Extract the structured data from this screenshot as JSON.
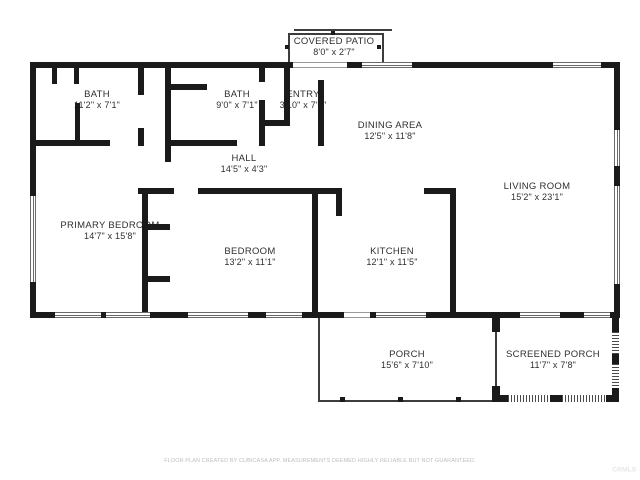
{
  "colors": {
    "wall": "#1a1a1a",
    "thin": "#3d3d3d",
    "text": "#2f2f2f",
    "footer": "#bdbdbd",
    "watermark": "#e6e6e6"
  },
  "rooms": [
    {
      "id": "covered-patio",
      "name": "COVERED PATIO",
      "dims": "8'0\" x 2'7\""
    },
    {
      "id": "bath-1",
      "name": "BATH",
      "dims": "11'2\" x 7'1\""
    },
    {
      "id": "bath-2",
      "name": "BATH",
      "dims": "9'0\" x 7'1\""
    },
    {
      "id": "entry",
      "name": "ENTRY",
      "dims": "3'10\" x 7'1\""
    },
    {
      "id": "dining-area",
      "name": "DINING AREA",
      "dims": "12'5\" x 11'8\""
    },
    {
      "id": "hall",
      "name": "HALL",
      "dims": "14'5\" x 4'3\""
    },
    {
      "id": "living-room",
      "name": "LIVING ROOM",
      "dims": "15'2\" x 23'1\""
    },
    {
      "id": "primary-bedroom",
      "name": "PRIMARY BEDROOM",
      "dims": "14'7\" x 15'8\""
    },
    {
      "id": "bedroom",
      "name": "BEDROOM",
      "dims": "13'2\" x 11'1\""
    },
    {
      "id": "kitchen",
      "name": "KITCHEN",
      "dims": "12'1\" x 11'5\""
    },
    {
      "id": "porch",
      "name": "PORCH",
      "dims": "15'6\" x 7'10\""
    },
    {
      "id": "screened-porch",
      "name": "SCREENED PORCH",
      "dims": "11'7\" x 7'8\""
    }
  ],
  "footer_text": "FLOOR PLAN CREATED BY CUBICASA APP. MEASUREMENTS DEEMED HIGHLY RELIABLE BUT NOT GUARANTEED.",
  "watermark": "CRMLS"
}
